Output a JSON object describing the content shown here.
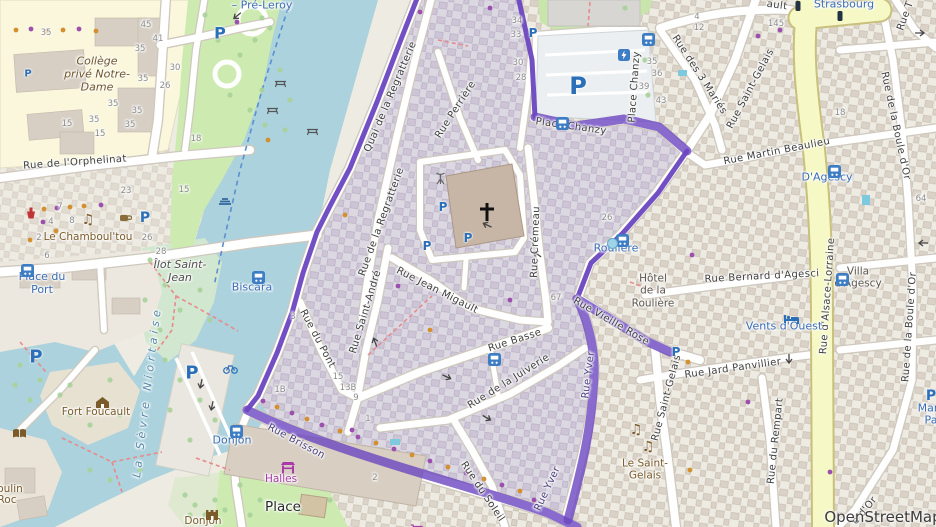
{
  "attribution": "OpenStreetMap",
  "colors": {
    "boundary_purple": "#6b46c1",
    "water_blue": "#abd2dd",
    "park_green": "#cdebb0",
    "secondary_road_yellow": "#f6f9c6",
    "education_yellow": "#faf7dc",
    "inner_district_tint": "#dcd8e2",
    "bus_blue": "#3d7dc4",
    "parking_blue": "#2a6fb8",
    "poi_brown": "#7a5b29",
    "shop_purple": "#ac39ac"
  },
  "labels": [
    {
      "text": "Rue de l'Orphelinat",
      "x": 75,
      "y": 163,
      "rot": -4,
      "cls": "street"
    },
    {
      "text": "Quai de la Regratterie",
      "x": 391,
      "y": 97,
      "rot": -67,
      "cls": "street"
    },
    {
      "text": "Rue de la Regratterie",
      "x": 382,
      "y": 222,
      "rot": -70,
      "cls": "street"
    },
    {
      "text": "Rue Perrière",
      "x": 456,
      "y": 110,
      "rot": -57,
      "cls": "street"
    },
    {
      "text": "Rue Crémeau",
      "x": 536,
      "y": 242,
      "rot": -88,
      "cls": "street"
    },
    {
      "text": "Rue Jean Migault",
      "x": 437,
      "y": 291,
      "rot": 27,
      "cls": "street"
    },
    {
      "text": "Rue Saint-André",
      "x": 366,
      "y": 312,
      "rot": -73,
      "cls": "street"
    },
    {
      "text": "Rue du Pont",
      "x": 317,
      "y": 339,
      "rot": 62,
      "cls": "street"
    },
    {
      "text": "Rue Basse",
      "x": 515,
      "y": 341,
      "rot": -18,
      "cls": "street"
    },
    {
      "text": "Rue de la Juiverie",
      "x": 509,
      "y": 382,
      "rot": -32,
      "cls": "street"
    },
    {
      "text": "Rue du Soleil",
      "x": 482,
      "y": 492,
      "rot": 56,
      "cls": "street"
    },
    {
      "text": "Rue Brisson",
      "x": 296,
      "y": 442,
      "rot": 28,
      "cls": "street-purple"
    },
    {
      "text": "Rue Yver",
      "x": 589,
      "y": 375,
      "rot": -83,
      "cls": "street-purple"
    },
    {
      "text": "Rue Yver",
      "x": 548,
      "y": 489,
      "rot": -65,
      "cls": "street-purple"
    },
    {
      "text": "Rue Vieille Rose",
      "x": 611,
      "y": 322,
      "rot": 30,
      "cls": "street"
    },
    {
      "text": "Place Chanzy",
      "x": 635,
      "y": 87,
      "rot": -86,
      "cls": "street"
    },
    {
      "text": "Place Chanzy",
      "x": 571,
      "y": 127,
      "rot": 8,
      "cls": "street"
    },
    {
      "text": "Rue des 3 Mariés",
      "x": 699,
      "y": 75,
      "rot": 57,
      "cls": "street"
    },
    {
      "text": "Rue Saint-Gelais",
      "x": 751,
      "y": 89,
      "rot": -62,
      "cls": "street"
    },
    {
      "text": "Rue Martin Beaulieu",
      "x": 777,
      "y": 152,
      "rot": -11,
      "cls": "street"
    },
    {
      "text": "Rue de la Boule d'Or",
      "x": 895,
      "y": 126,
      "rot": 78,
      "cls": "street"
    },
    {
      "text": "Rue d'Alsace-Lorraine",
      "x": 828,
      "y": 296,
      "rot": -86,
      "cls": "street"
    },
    {
      "text": "Rue Bernard d'Agesci",
      "x": 762,
      "y": 277,
      "rot": -3,
      "cls": "street"
    },
    {
      "text": "Rue Jard Panvillier",
      "x": 733,
      "y": 369,
      "rot": -8,
      "cls": "street"
    },
    {
      "text": "Rue Saint-Gelais",
      "x": 667,
      "y": 398,
      "rot": -75,
      "cls": "street"
    },
    {
      "text": "Rue du Rempart",
      "x": 776,
      "y": 441,
      "rot": -84,
      "cls": "street"
    },
    {
      "text": "Rue de la Boule d'Or",
      "x": 910,
      "y": 327,
      "rot": -86,
      "cls": "street"
    },
    {
      "text": "Strasbourg",
      "x": 844,
      "y": 5,
      "rot": 0,
      "cls": "poi-blue"
    },
    {
      "text": "ault",
      "x": 777,
      "y": 6,
      "rot": 8,
      "cls": "street"
    },
    {
      "text": "Rue T",
      "x": 906,
      "y": 16,
      "rot": -70,
      "cls": "street"
    },
    {
      "text": "e d'Or",
      "x": 865,
      "y": 511,
      "rot": -50,
      "cls": "street"
    },
    {
      "text": "– Pré-Leroy",
      "x": 262,
      "y": 6,
      "rot": 0,
      "cls": "poi-blue"
    },
    {
      "text": "Collège\nprivé Notre-\nDame",
      "x": 97,
      "y": 75,
      "rot": 0,
      "cls": "school"
    },
    {
      "text": "Le Chamboul'tou",
      "x": 88,
      "y": 237,
      "rot": 0,
      "cls": "poi-brown"
    },
    {
      "text": "Place du\nPort",
      "x": 42,
      "y": 284,
      "rot": 0,
      "cls": "poi-blue"
    },
    {
      "text": "Îlot Saint-\nJean",
      "x": 180,
      "y": 272,
      "rot": 0,
      "cls": "island"
    },
    {
      "text": "La Sèvre Niortaise",
      "x": 148,
      "y": 392,
      "rot": -83,
      "cls": "river"
    },
    {
      "text": "Biscara",
      "x": 252,
      "y": 288,
      "rot": 0,
      "cls": "poi-blue"
    },
    {
      "text": "Fort Foucault",
      "x": 96,
      "y": 412,
      "rot": 0,
      "cls": "poi-brown"
    },
    {
      "text": "Roulière",
      "x": 616,
      "y": 249,
      "rot": 0,
      "cls": "poi-blue"
    },
    {
      "text": "Hôtel\nde la\nRoulière",
      "x": 653,
      "y": 291,
      "rot": 0,
      "cls": "poi-dark"
    },
    {
      "text": "Villa\nd'Agescy",
      "x": 858,
      "y": 278,
      "rot": 0,
      "cls": "poi-dark"
    },
    {
      "text": "D'Agescy",
      "x": 827,
      "y": 178,
      "rot": 0,
      "cls": "poi-blue"
    },
    {
      "text": "Vents d'Ouest",
      "x": 784,
      "y": 327,
      "rot": 0,
      "cls": "poi-blue"
    },
    {
      "text": "Le Saint-\nGelais",
      "x": 645,
      "y": 470,
      "rot": 0,
      "cls": "poi-brown"
    },
    {
      "text": "Halles",
      "x": 281,
      "y": 479,
      "rot": 0,
      "cls": "poi-purple"
    },
    {
      "text": "Donjon",
      "x": 232,
      "y": 441,
      "rot": 0,
      "cls": "poi-blue"
    },
    {
      "text": "Donjon",
      "x": 203,
      "y": 521,
      "rot": 0,
      "cls": "poi-brown"
    },
    {
      "text": "Place",
      "x": 283,
      "y": 508,
      "rot": 0,
      "cls": "place"
    },
    {
      "text": "Mar",
      "x": 928,
      "y": 409,
      "rot": 0,
      "cls": "poi-blue"
    },
    {
      "text": "Pa",
      "x": 931,
      "y": 421,
      "rot": 0,
      "cls": "poi-blue"
    },
    {
      "text": "oulin",
      "x": 10,
      "y": 489,
      "rot": 0,
      "cls": "poi-brown"
    },
    {
      "text": "Roc",
      "x": 7,
      "y": 500,
      "rot": 0,
      "cls": "poi-brown"
    },
    {
      "text": "35",
      "x": 46,
      "y": 33,
      "rot": 0,
      "cls": "num"
    },
    {
      "text": "45",
      "x": 146,
      "y": 25,
      "rot": 0,
      "cls": "num"
    },
    {
      "text": "41",
      "x": 158,
      "y": 39,
      "rot": 0,
      "cls": "num"
    },
    {
      "text": "35",
      "x": 140,
      "y": 49,
      "rot": 0,
      "cls": "num"
    },
    {
      "text": "35",
      "x": 143,
      "y": 79,
      "rot": 0,
      "cls": "num"
    },
    {
      "text": "35",
      "x": 113,
      "y": 104,
      "rot": 0,
      "cls": "num"
    },
    {
      "text": "35",
      "x": 137,
      "y": 111,
      "rot": 0,
      "cls": "num"
    },
    {
      "text": "35",
      "x": 94,
      "y": 120,
      "rot": 0,
      "cls": "num"
    },
    {
      "text": "35",
      "x": 130,
      "y": 125,
      "rot": 0,
      "cls": "num"
    },
    {
      "text": "15",
      "x": 67,
      "y": 124,
      "rot": 0,
      "cls": "num"
    },
    {
      "text": "15",
      "x": 100,
      "y": 134,
      "rot": 0,
      "cls": "num"
    },
    {
      "text": "30",
      "x": 175,
      "y": 68,
      "rot": 0,
      "cls": "num"
    },
    {
      "text": "26",
      "x": 165,
      "y": 86,
      "rot": 0,
      "cls": "num"
    },
    {
      "text": "18",
      "x": 196,
      "y": 139,
      "rot": 0,
      "cls": "num"
    },
    {
      "text": "34",
      "x": 517,
      "y": 21,
      "rot": 0,
      "cls": "num"
    },
    {
      "text": "33",
      "x": 516,
      "y": 35,
      "rot": 0,
      "cls": "num"
    },
    {
      "text": "30",
      "x": 518,
      "y": 63,
      "rot": 0,
      "cls": "num"
    },
    {
      "text": "28",
      "x": 521,
      "y": 78,
      "rot": 0,
      "cls": "num"
    },
    {
      "text": "4",
      "x": 697,
      "y": 17,
      "rot": 0,
      "cls": "num"
    },
    {
      "text": "12",
      "x": 699,
      "y": 28,
      "rot": 0,
      "cls": "num"
    },
    {
      "text": "145",
      "x": 776,
      "y": 24,
      "rot": 0,
      "cls": "num"
    },
    {
      "text": "35",
      "x": 652,
      "y": 62,
      "rot": 0,
      "cls": "num"
    },
    {
      "text": "36",
      "x": 657,
      "y": 74,
      "rot": 0,
      "cls": "num"
    },
    {
      "text": "39",
      "x": 644,
      "y": 87,
      "rot": 0,
      "cls": "num"
    },
    {
      "text": "43",
      "x": 661,
      "y": 101,
      "rot": 0,
      "cls": "num"
    },
    {
      "text": "64",
      "x": 921,
      "y": 199,
      "rot": 0,
      "cls": "num"
    },
    {
      "text": "26",
      "x": 607,
      "y": 218,
      "rot": 0,
      "cls": "num"
    },
    {
      "text": "67",
      "x": 556,
      "y": 298,
      "rot": 0,
      "cls": "num"
    },
    {
      "text": "23",
      "x": 126,
      "y": 191,
      "rot": 0,
      "cls": "num"
    },
    {
      "text": "15",
      "x": 184,
      "y": 190,
      "rot": 0,
      "cls": "num"
    },
    {
      "text": "7",
      "x": 60,
      "y": 207,
      "rot": 0,
      "cls": "num"
    },
    {
      "text": "4",
      "x": 51,
      "y": 222,
      "rot": 0,
      "cls": "num"
    },
    {
      "text": "8",
      "x": 72,
      "y": 221,
      "rot": 0,
      "cls": "num"
    },
    {
      "text": "2",
      "x": 39,
      "y": 238,
      "rot": 0,
      "cls": "num"
    },
    {
      "text": "6",
      "x": 47,
      "y": 256,
      "rot": 0,
      "cls": "num"
    },
    {
      "text": "26",
      "x": 147,
      "y": 238,
      "rot": 0,
      "cls": "num"
    },
    {
      "text": "28",
      "x": 161,
      "y": 252,
      "rot": 0,
      "cls": "num"
    },
    {
      "text": "15",
      "x": 338,
      "y": 377,
      "rot": 0,
      "cls": "num"
    },
    {
      "text": "13B",
      "x": 348,
      "y": 388,
      "rot": 0,
      "cls": "num"
    },
    {
      "text": "9",
      "x": 356,
      "y": 398,
      "rot": 0,
      "cls": "num"
    },
    {
      "text": "1B",
      "x": 280,
      "y": 390,
      "rot": 0,
      "cls": "num"
    },
    {
      "text": "1",
      "x": 368,
      "y": 419,
      "rot": 0,
      "cls": "num"
    },
    {
      "text": "2",
      "x": 375,
      "y": 478,
      "rot": 0,
      "cls": "num"
    },
    {
      "text": "3",
      "x": 293,
      "y": 317,
      "rot": 0,
      "cls": "num"
    },
    {
      "text": "18",
      "x": 840,
      "y": 113,
      "rot": 0,
      "cls": "num"
    }
  ],
  "icons": [
    {
      "t": "parking",
      "x": 578,
      "y": 86,
      "s": 24
    },
    {
      "t": "parking",
      "x": 533,
      "y": 33,
      "s": 12
    },
    {
      "t": "parking",
      "x": 220,
      "y": 33,
      "s": 16
    },
    {
      "t": "parking",
      "x": 28,
      "y": 74,
      "s": 10
    },
    {
      "t": "parking",
      "x": 145,
      "y": 218,
      "s": 14
    },
    {
      "t": "parking",
      "x": 192,
      "y": 373,
      "s": 18
    },
    {
      "t": "parking",
      "x": 36,
      "y": 357,
      "s": 18
    },
    {
      "t": "parking",
      "x": 443,
      "y": 207,
      "s": 12
    },
    {
      "t": "parking",
      "x": 468,
      "y": 238,
      "s": 12
    },
    {
      "t": "parking",
      "x": 427,
      "y": 246,
      "s": 12
    },
    {
      "t": "parking",
      "x": 676,
      "y": 352,
      "s": 12
    },
    {
      "t": "parking",
      "x": 931,
      "y": 396,
      "s": 14
    },
    {
      "t": "bus",
      "x": 642,
      "y": 33
    },
    {
      "t": "bus",
      "x": 556,
      "y": 117
    },
    {
      "t": "bus",
      "x": 828,
      "y": 165
    },
    {
      "t": "bus",
      "x": 836,
      "y": 273
    },
    {
      "t": "bus",
      "x": 230,
      "y": 425
    },
    {
      "t": "bus",
      "x": 252,
      "y": 271
    },
    {
      "t": "bus",
      "x": 21,
      "y": 264
    },
    {
      "t": "bus",
      "x": 488,
      "y": 353
    },
    {
      "t": "bus",
      "x": 616,
      "y": 234
    },
    {
      "t": "dotblue",
      "x": 607,
      "y": 238
    },
    {
      "t": "charging",
      "x": 618,
      "y": 49
    },
    {
      "t": "pharmacy",
      "x": 25,
      "y": 207
    },
    {
      "t": "cafe",
      "x": 119,
      "y": 212
    },
    {
      "t": "music",
      "x": 88,
      "y": 220
    },
    {
      "t": "music",
      "x": 636,
      "y": 430
    },
    {
      "t": "music",
      "x": 648,
      "y": 447
    },
    {
      "t": "book",
      "x": 12,
      "y": 428
    },
    {
      "t": "fort",
      "x": 95,
      "y": 396
    },
    {
      "t": "castle",
      "x": 205,
      "y": 509
    },
    {
      "t": "market",
      "x": 280,
      "y": 461
    },
    {
      "t": "hotel",
      "x": 784,
      "y": 313
    },
    {
      "t": "bike",
      "x": 223,
      "y": 364
    },
    {
      "t": "weir",
      "x": 218,
      "y": 196
    },
    {
      "t": "picnic",
      "x": 274,
      "y": 79
    },
    {
      "t": "picnic",
      "x": 266,
      "y": 106
    },
    {
      "t": "picnic",
      "x": 306,
      "y": 127
    },
    {
      "t": "antenna",
      "x": 435,
      "y": 172
    },
    {
      "t": "cart",
      "x": 410,
      "y": 524
    },
    {
      "t": "cross",
      "x": 479,
      "y": 203
    }
  ]
}
